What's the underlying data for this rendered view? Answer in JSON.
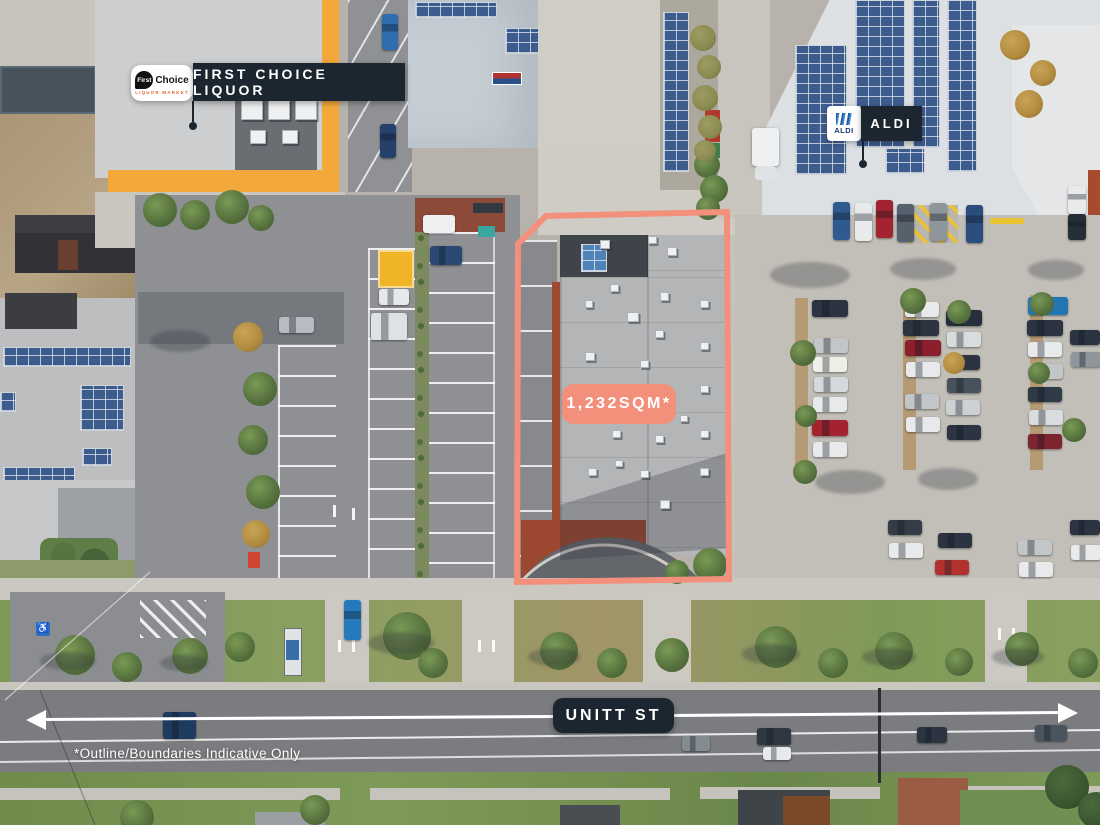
{
  "annotations": {
    "first_choice": {
      "label": "FIRST CHOICE LIQUOR",
      "logo_first": "First",
      "logo_choice": "Choice",
      "logo_tagline": "LIQUOR MARKET"
    },
    "aldi": {
      "label": "ALDI",
      "logo_text": "ALDI"
    },
    "area_label": "1,232SQM*",
    "street_label": "UNITT ST",
    "disclaimer": "*Outline/Boundaries Indicative Only"
  },
  "colors": {
    "boundary_salmon": "#F2907B",
    "label_navy": "#1C2631",
    "annotation_white": "#FFFFFF"
  }
}
